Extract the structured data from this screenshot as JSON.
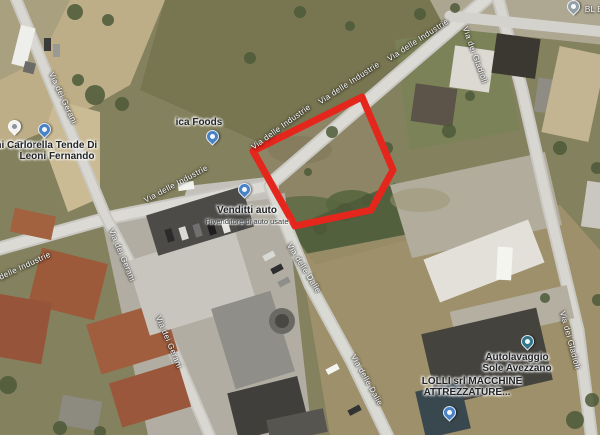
{
  "red_plot": {
    "points": "253,151 362,97 393,170 371,210 295,226",
    "color": "#e5261d",
    "stroke_width": "7"
  },
  "road_labels": [
    {
      "text": "Via delle Industrie"
    },
    {
      "text": "Via delle Industrie"
    },
    {
      "text": "Via delle Industrie"
    },
    {
      "text": "Via delle Industrie"
    },
    {
      "text": "Via delle Industrie"
    },
    {
      "text": "Via dei Gerani"
    },
    {
      "text": "Via dei Gerani"
    },
    {
      "text": "Via dei Gerani"
    },
    {
      "text": "Via delle Dalie"
    },
    {
      "text": "Via delle Dalie"
    },
    {
      "text": "Via dei Gladioli"
    },
    {
      "text": "Via dei Gladioli"
    }
  ],
  "pois": {
    "ica_foods": {
      "name": "ica Foods"
    },
    "venditti": {
      "name": "Venditti auto",
      "subtitle": "Rivenditore di auto usate"
    },
    "petrella": {
      "line1": "Petrella Tende Di",
      "line2": "Leoni Fernando"
    },
    "ni_carlo": {
      "name": "ni Carlo"
    },
    "autolavaggio": {
      "line1": "Autolavaggio",
      "line2": "Sole Avezzano"
    },
    "lolli": {
      "line1": "LOLLI srl MACCHINE",
      "line2": "ATTREZZATURE..."
    },
    "bl_edil": {
      "name": "BL Edil"
    }
  }
}
